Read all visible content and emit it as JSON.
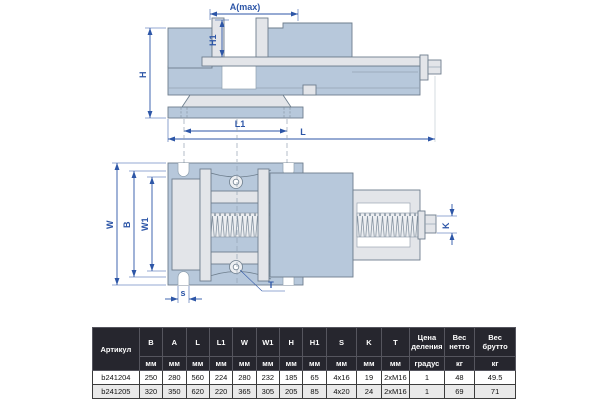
{
  "drawing": {
    "labels": {
      "a_max": "A(max)",
      "h1": "H1",
      "h": "H",
      "l1": "L1",
      "l": "L",
      "w": "W",
      "b": "B",
      "w1": "W1",
      "s": "s",
      "t": "T",
      "k": "K"
    },
    "colors": {
      "body_blue": "#b7c8db",
      "part_grey": "#e3e5e9",
      "outline": "#6e7e8d",
      "dimension_blue": "#2d56a7",
      "table_header_bg": "#26262e",
      "table_alt_row": "#e9e9e9"
    }
  },
  "table": {
    "article_header": "Артикул",
    "dim_columns": [
      "B",
      "A",
      "L",
      "L1",
      "W",
      "W1",
      "H",
      "H1",
      "S",
      "K",
      "T"
    ],
    "spec_columns": [
      "Цена деления",
      "Вес нетто",
      "Вес брутто"
    ],
    "mm_unit": "мм",
    "spec_units": [
      "градус",
      "кг",
      "кг"
    ],
    "rows": [
      {
        "article": "b241204",
        "values": [
          "250",
          "280",
          "560",
          "224",
          "280",
          "232",
          "185",
          "65",
          "4x16",
          "19",
          "2xM16",
          "1",
          "48",
          "49.5"
        ]
      },
      {
        "article": "b241205",
        "values": [
          "320",
          "350",
          "620",
          "220",
          "365",
          "305",
          "205",
          "85",
          "4x20",
          "24",
          "2xM16",
          "1",
          "69",
          "71"
        ]
      }
    ]
  }
}
